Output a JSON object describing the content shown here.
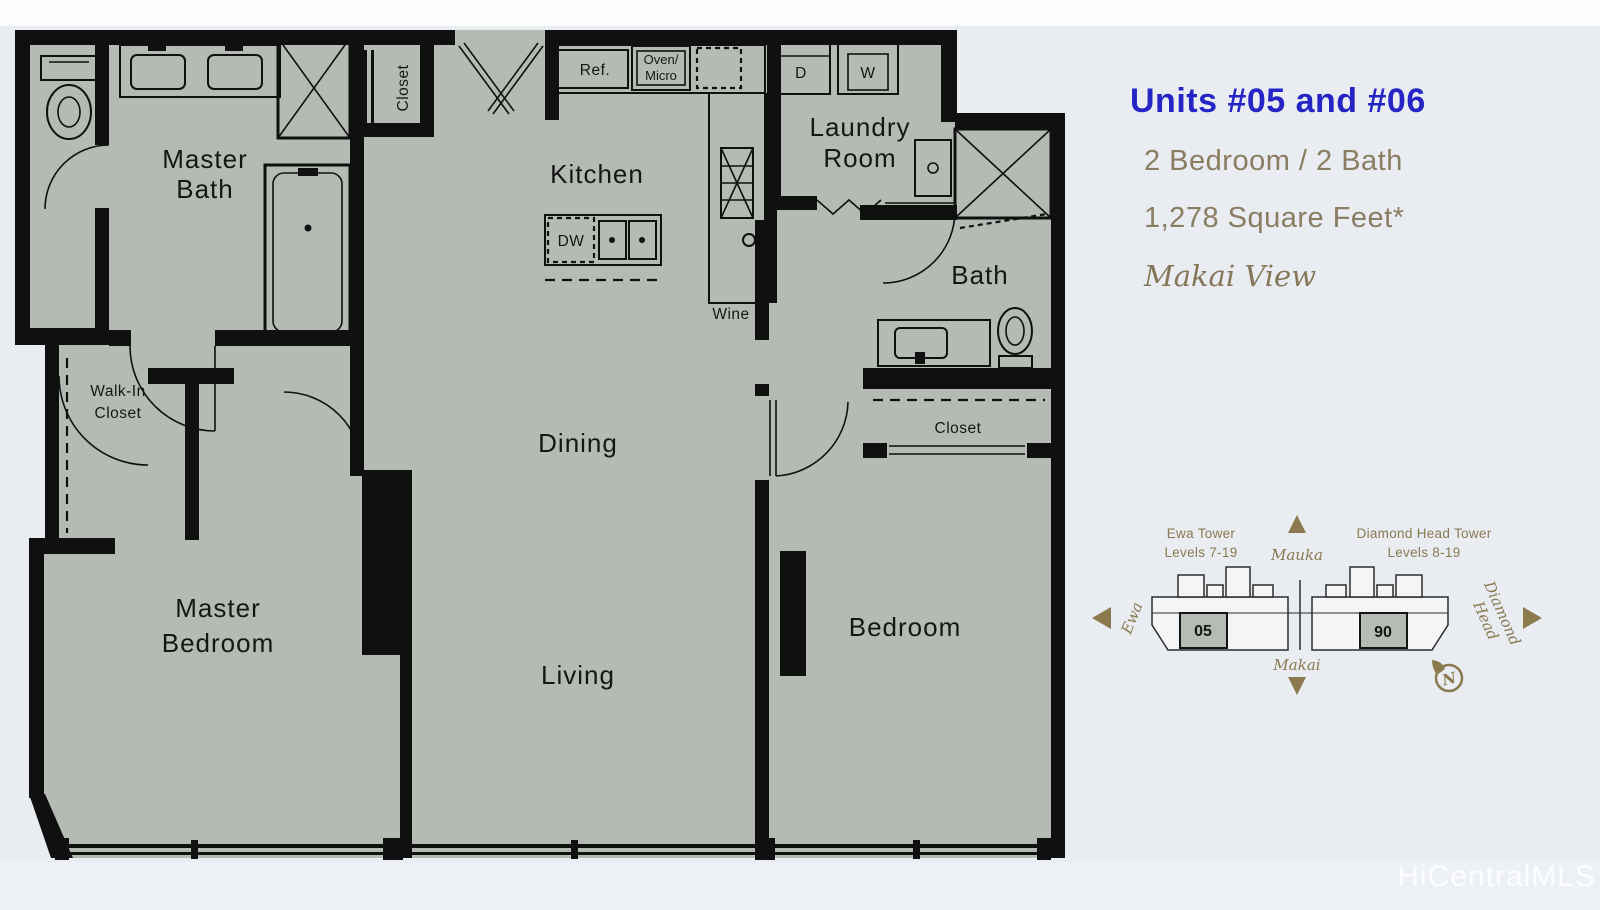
{
  "panel": {
    "title": "Units #05 and #06",
    "bed_bath": "2 Bedroom / 2 Bath",
    "sqft": "1,278 Square Feet*",
    "view": "Makai View"
  },
  "floorplan": {
    "labels": {
      "master_bath_1": "Master",
      "master_bath_2": "Bath",
      "closet_entry": "Closet",
      "kitchen": "Kitchen",
      "ref": "Ref.",
      "oven_1": "Oven/",
      "oven_2": "Micro",
      "dw": "DW",
      "wine": "Wine",
      "laundry_1": "Laundry",
      "laundry_2": "Room",
      "dryer": "D",
      "washer": "W",
      "bath": "Bath",
      "closet_bedroom": "Closet",
      "walk_in_1": "Walk-In",
      "walk_in_2": "Closet",
      "dining": "Dining",
      "living": "Living",
      "master_bedroom_1": "Master",
      "master_bedroom_2": "Bedroom",
      "bedroom": "Bedroom"
    }
  },
  "site_diagram": {
    "ewa_tower_1": "Ewa Tower",
    "ewa_tower_2": "Levels 7-19",
    "mauka": "Mauka",
    "diamond_head_tower_1": "Diamond Head Tower",
    "diamond_head_tower_2": "Levels 8-19",
    "ewa": "Ewa",
    "makai": "Makai",
    "diamond_head_1": "Diamond",
    "diamond_head_2": "Head",
    "unit_05": "05",
    "unit_06": "06",
    "compass_n": "N"
  },
  "watermark": "HiCentralMLS",
  "colors": {
    "accent_blue": "#2525c6",
    "tan_text": "#8a7d61",
    "diagram_gold": "#8a7a4e",
    "floor_fill": "#b3bbb3",
    "wall": "#101010",
    "background": "#e9edf2"
  }
}
